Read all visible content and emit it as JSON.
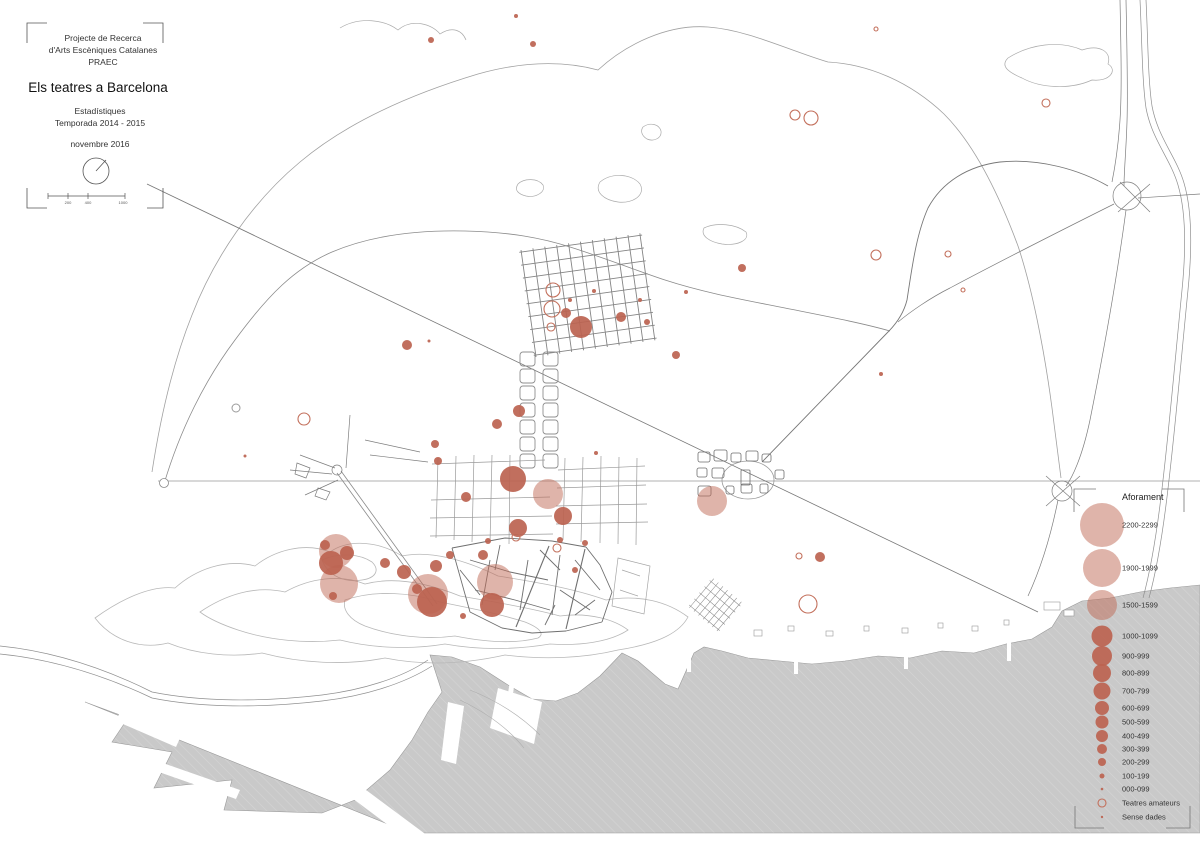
{
  "title_block": {
    "line1": "Projecte de Recerca",
    "line2": "d'Arts Escèniques Catalanes",
    "line3": "PRAEC",
    "main_title": "Els teatres a Barcelona",
    "subtitle1": "Estadístiques",
    "subtitle2": "Temporada 2014 - 2015",
    "date": "novembre 2016"
  },
  "scale_bar": {
    "ticks": [
      "200",
      "400",
      "1000"
    ]
  },
  "legend": {
    "title": "Aforament",
    "cx": 1102,
    "label_x": 1122,
    "entries": [
      {
        "label": "2200-2299",
        "cy": 525,
        "r": 22,
        "style": "pink"
      },
      {
        "label": "1900-1999",
        "cy": 568,
        "r": 19,
        "style": "pink"
      },
      {
        "label": "1500-1599",
        "cy": 605,
        "r": 15,
        "style": "pink"
      },
      {
        "label": "1000-1099",
        "cy": 636,
        "r": 10.5,
        "style": "dark"
      },
      {
        "label": "900-999",
        "cy": 656,
        "r": 10,
        "style": "dark"
      },
      {
        "label": "800-899",
        "cy": 673,
        "r": 9,
        "style": "dark"
      },
      {
        "label": "700-799",
        "cy": 691,
        "r": 8.5,
        "style": "dark"
      },
      {
        "label": "600-699",
        "cy": 708,
        "r": 7,
        "style": "dark"
      },
      {
        "label": "500-599",
        "cy": 722,
        "r": 6.5,
        "style": "dark"
      },
      {
        "label": "400-499",
        "cy": 736,
        "r": 6,
        "style": "dark"
      },
      {
        "label": "300-399",
        "cy": 749,
        "r": 5,
        "style": "dark"
      },
      {
        "label": "200-299",
        "cy": 762,
        "r": 4,
        "style": "dark"
      },
      {
        "label": "100-199",
        "cy": 776,
        "r": 2.5,
        "style": "dark"
      },
      {
        "label": "000-099",
        "cy": 789,
        "r": 1.3,
        "style": "dark"
      },
      {
        "label": "Teatres amateurs",
        "cy": 803,
        "r": 4,
        "style": "open"
      },
      {
        "label": "Sense dades",
        "cy": 817,
        "r": 1.2,
        "style": "dark"
      }
    ]
  },
  "map": {
    "styles": {
      "pink": {
        "fill": "#c06a55",
        "fill_opacity": 0.5
      },
      "dark": {
        "fill": "#bc6350",
        "fill_opacity": 0.92
      },
      "open": {
        "stroke": "#c3705c",
        "stroke_width": 1.1
      },
      "open_gray": {
        "stroke": "#9a9a9a",
        "stroke_width": 1
      }
    },
    "colors": {
      "sea": "#c9c9c9",
      "sea_hatch": "#d5d5d5",
      "contour": "#b8b8b8",
      "road": "#777777",
      "accent_red": "#bc6350"
    },
    "points": [
      {
        "x": 336,
        "y": 551,
        "r": 17,
        "style": "pink"
      },
      {
        "x": 331,
        "y": 563,
        "r": 12,
        "style": "dark"
      },
      {
        "x": 339,
        "y": 584,
        "r": 19,
        "style": "pink"
      },
      {
        "x": 333,
        "y": 596,
        "r": 4,
        "style": "dark"
      },
      {
        "x": 325,
        "y": 545,
        "r": 5,
        "style": "dark"
      },
      {
        "x": 347,
        "y": 553,
        "r": 7,
        "style": "dark"
      },
      {
        "x": 385,
        "y": 563,
        "r": 5,
        "style": "dark"
      },
      {
        "x": 404,
        "y": 572,
        "r": 7,
        "style": "dark"
      },
      {
        "x": 428,
        "y": 594,
        "r": 20,
        "style": "pink"
      },
      {
        "x": 432,
        "y": 602,
        "r": 15,
        "style": "dark"
      },
      {
        "x": 417,
        "y": 589,
        "r": 5,
        "style": "dark"
      },
      {
        "x": 450,
        "y": 555,
        "r": 4,
        "style": "dark"
      },
      {
        "x": 436,
        "y": 566,
        "r": 6,
        "style": "dark"
      },
      {
        "x": 495,
        "y": 582,
        "r": 18,
        "style": "pink"
      },
      {
        "x": 492,
        "y": 605,
        "r": 12,
        "style": "dark"
      },
      {
        "x": 483,
        "y": 555,
        "r": 5,
        "style": "dark"
      },
      {
        "x": 463,
        "y": 616,
        "r": 3,
        "style": "dark"
      },
      {
        "x": 488,
        "y": 541,
        "r": 3,
        "style": "dark"
      },
      {
        "x": 575,
        "y": 570,
        "r": 3,
        "style": "dark"
      },
      {
        "x": 585,
        "y": 543,
        "r": 3,
        "style": "dark"
      },
      {
        "x": 560,
        "y": 540,
        "r": 3,
        "style": "dark"
      },
      {
        "x": 548,
        "y": 494,
        "r": 15,
        "style": "pink"
      },
      {
        "x": 513,
        "y": 479,
        "r": 13,
        "style": "dark"
      },
      {
        "x": 518,
        "y": 528,
        "r": 9,
        "style": "dark"
      },
      {
        "x": 563,
        "y": 516,
        "r": 9,
        "style": "dark"
      },
      {
        "x": 516,
        "y": 537,
        "r": 4,
        "style": "open"
      },
      {
        "x": 557,
        "y": 548,
        "r": 4,
        "style": "open"
      },
      {
        "x": 519,
        "y": 411,
        "r": 6,
        "style": "dark"
      },
      {
        "x": 497,
        "y": 424,
        "r": 5,
        "style": "dark"
      },
      {
        "x": 466,
        "y": 497,
        "r": 5,
        "style": "dark"
      },
      {
        "x": 596,
        "y": 453,
        "r": 2,
        "style": "dark"
      },
      {
        "x": 553,
        "y": 290,
        "r": 7,
        "style": "open"
      },
      {
        "x": 552,
        "y": 309,
        "r": 8,
        "style": "open"
      },
      {
        "x": 551,
        "y": 327,
        "r": 4,
        "style": "open"
      },
      {
        "x": 566,
        "y": 313,
        "r": 5,
        "style": "dark"
      },
      {
        "x": 581,
        "y": 327,
        "r": 11,
        "style": "dark"
      },
      {
        "x": 621,
        "y": 317,
        "r": 5,
        "style": "dark"
      },
      {
        "x": 594,
        "y": 291,
        "r": 2,
        "style": "dark"
      },
      {
        "x": 570,
        "y": 300,
        "r": 2,
        "style": "dark"
      },
      {
        "x": 640,
        "y": 300,
        "r": 2,
        "style": "dark"
      },
      {
        "x": 647,
        "y": 322,
        "r": 3,
        "style": "dark"
      },
      {
        "x": 676,
        "y": 355,
        "r": 4,
        "style": "dark"
      },
      {
        "x": 742,
        "y": 268,
        "r": 4,
        "style": "dark"
      },
      {
        "x": 686,
        "y": 292,
        "r": 2,
        "style": "dark"
      },
      {
        "x": 533,
        "y": 44,
        "r": 3,
        "style": "dark"
      },
      {
        "x": 431,
        "y": 40,
        "r": 3,
        "style": "dark"
      },
      {
        "x": 516,
        "y": 16,
        "r": 2,
        "style": "dark"
      },
      {
        "x": 876,
        "y": 29,
        "r": 2,
        "style": "open"
      },
      {
        "x": 407,
        "y": 345,
        "r": 5,
        "style": "dark"
      },
      {
        "x": 429,
        "y": 341,
        "r": 1.5,
        "style": "dark"
      },
      {
        "x": 304,
        "y": 419,
        "r": 6,
        "style": "open"
      },
      {
        "x": 236,
        "y": 408,
        "r": 4,
        "style": "open_gray"
      },
      {
        "x": 435,
        "y": 444,
        "r": 4,
        "style": "dark"
      },
      {
        "x": 438,
        "y": 461,
        "r": 4,
        "style": "dark"
      },
      {
        "x": 245,
        "y": 456,
        "r": 1.5,
        "style": "dark"
      },
      {
        "x": 795,
        "y": 115,
        "r": 5,
        "style": "open"
      },
      {
        "x": 811,
        "y": 118,
        "r": 7,
        "style": "open"
      },
      {
        "x": 1046,
        "y": 103,
        "r": 4,
        "style": "open"
      },
      {
        "x": 876,
        "y": 255,
        "r": 5,
        "style": "open"
      },
      {
        "x": 948,
        "y": 254,
        "r": 3,
        "style": "open"
      },
      {
        "x": 963,
        "y": 290,
        "r": 2,
        "style": "open"
      },
      {
        "x": 881,
        "y": 374,
        "r": 2,
        "style": "dark"
      },
      {
        "x": 820,
        "y": 557,
        "r": 5,
        "style": "dark"
      },
      {
        "x": 799,
        "y": 556,
        "r": 3,
        "style": "open"
      },
      {
        "x": 808,
        "y": 604,
        "r": 9,
        "style": "open"
      },
      {
        "x": 712,
        "y": 501,
        "r": 15,
        "style": "pink"
      }
    ]
  }
}
